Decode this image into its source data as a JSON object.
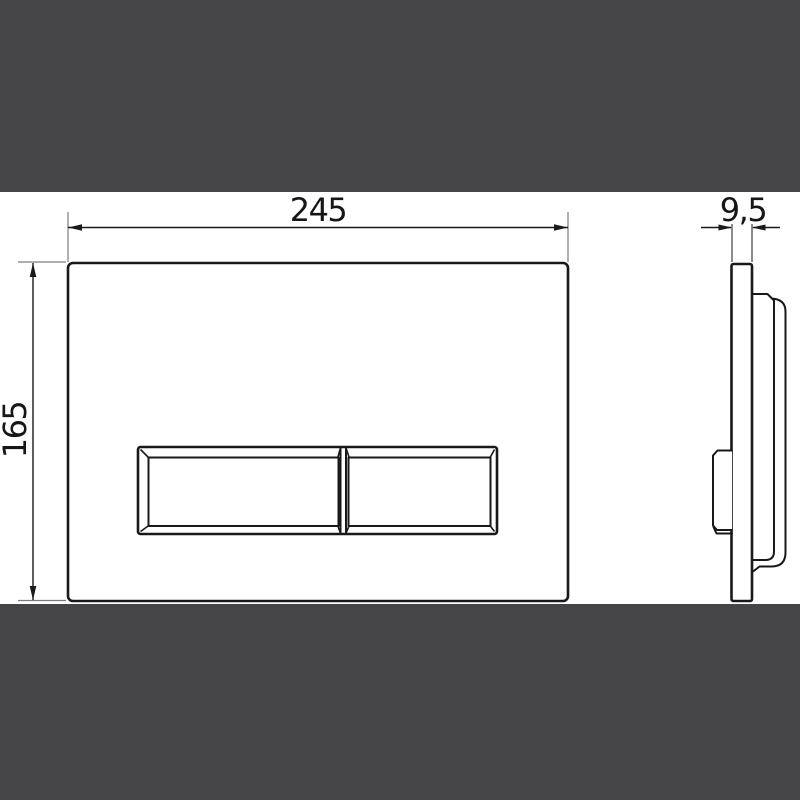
{
  "page": {
    "description": "Technical dimension drawing of a dual-flush WC actuator plate: front view with flush buttons and side profile view",
    "background_color": "#ffffff",
    "letterbox_color": "#454547"
  },
  "drawing": {
    "line_color": "#191919",
    "dimension_line_color": "#1a1a1a",
    "extension_line_color": "#7d7d7d",
    "labels": {
      "width": "245",
      "height": "165",
      "thickness": "9,5"
    }
  }
}
